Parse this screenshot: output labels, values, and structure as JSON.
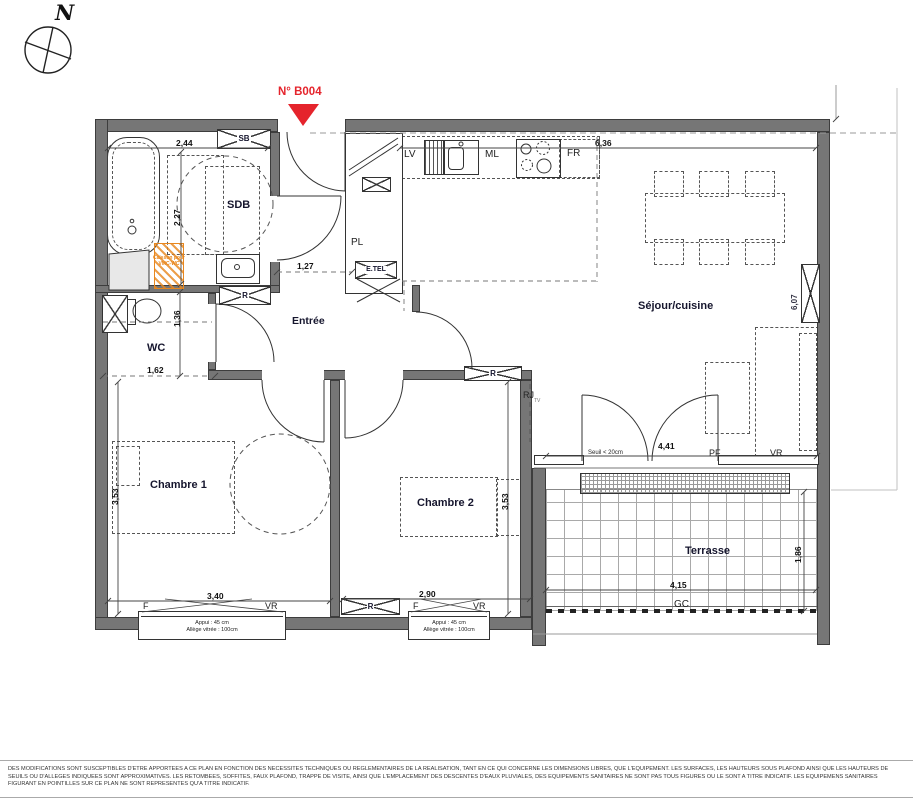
{
  "header": {
    "unit_label": "N° B004",
    "compass_letter": "N"
  },
  "rooms": {
    "sdb": "SDB",
    "wc": "WC",
    "entree": "Entrée",
    "sejour": "Séjour/cuisine",
    "chambre1": "Chambre 1",
    "chambre2": "Chambre 2",
    "terrasse": "Terrasse"
  },
  "appliances": {
    "lv": "LV",
    "ml": "ML",
    "fr": "FR"
  },
  "fixtures": {
    "pl": "PL",
    "sb": "SB",
    "r": "R",
    "rj": "RJ",
    "rj_sub": "TV",
    "etel": "E.TEL",
    "f": "F",
    "vr": "VR",
    "pf": "PF",
    "gc": "GC"
  },
  "dimensions": {
    "sdb_width": "2,44",
    "sdb_height": "2,27",
    "entree_width": "1,27",
    "wc_height": "1,36",
    "wc_width": "1,62",
    "sejour_width": "6,36",
    "sejour_height": "6,07",
    "chambre1_height": "3,53",
    "chambre1_width": "3,40",
    "chambre2_width": "2,90",
    "chambre2_height": "3,53",
    "baie_width": "4,41",
    "terrasse_width": "4,15",
    "terrasse_height": "1,86"
  },
  "annotations": {
    "seuil": "Seuil < 20cm",
    "appui": "Appui : 45 cm",
    "allege": "Allège vitrée : 100cm",
    "caisson_line1": "Caisson pour",
    "caisson_line2": "VMC-WC"
  },
  "colors": {
    "marker_red": "#e5242c",
    "caisson_orange": "#e8871e",
    "wall_grey": "#767676"
  },
  "footer": {
    "disclaimer": "DES MODIFICATIONS SONT SUSCEPTIBLES D'ETRE APPORTEES A CE PLAN EN FONCTION DES NECESSITES TECHNIQUES OU REGLEMENTAIRES DE LA REALISATION, TANT EN CE QUI CONCERNE LES DIMENSIONS LIBRES, QUE L'EQUIPEMENT. LES SURFACES, LES HAUTEURS SOUS PLAFOND AINSI QUE LES HAUTEURS DE SEUILS OU D'ALLEGES INDIQUEES SONT APPROXIMATIVES. LES RETOMBEES, SOFFITES, FAUX PLAFOND, TRAPPE DE VISITE, AINSI QUE L'EMPLACEMENT DES DESCENTES D'EAUX PLUVIALES, DES EQUIPEMENTS SANITAIRES NE SONT PAS TOUS FIGURES OU LE SONT A TITRE INDICATIF. LES EQUIPEMENS SANITAIRES FIGURANT EN POINTILLES SUR CE PLAN NE SONT REPRESENTES QU'A TITRE INDICATIF."
  }
}
